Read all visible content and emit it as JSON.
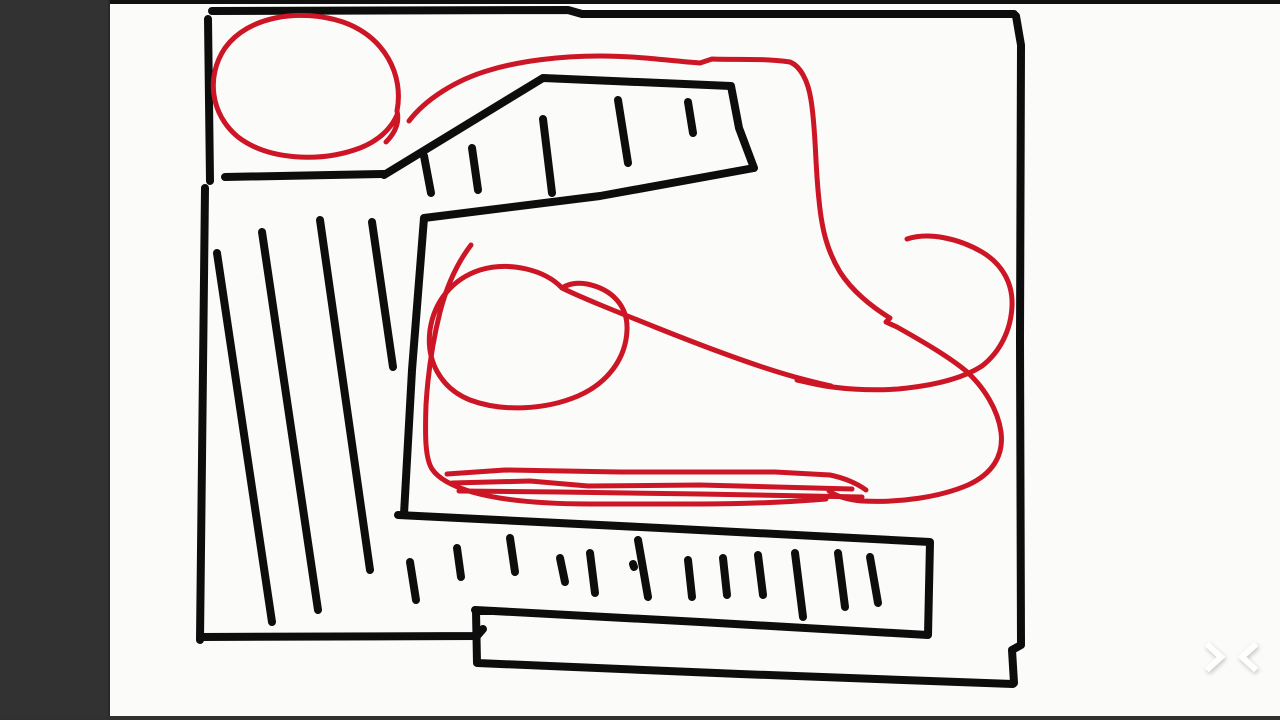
{
  "theme": {
    "frame_bg": "#141414",
    "top_strip": "#101010",
    "bottom_strip": "#303030",
    "sidebar": "#323232",
    "sidebar_edge": "#282828",
    "canvas": "#fbfbfa",
    "chevron": "#ffffff",
    "ink_black": "#0d0d0d",
    "ink_red": "#cc1626"
  },
  "nav": {
    "icons": [
      {
        "name": "chevron-right-icon",
        "shape": "right"
      },
      {
        "name": "chevron-left-icon",
        "shape": "left"
      }
    ]
  },
  "drawing": {
    "black_width": 8,
    "red_width": 5,
    "strokes": [
      {
        "id": "border-top",
        "color": "black",
        "path": "M 212 11 L 568 10 L 582 14 L 1014 14"
      },
      {
        "id": "border-right",
        "color": "black",
        "path": "M 1016 16 L 1021 45 L 1020 340 L 1021 645 L 1012 650 L 1014 683"
      },
      {
        "id": "border-left-upper",
        "color": "black",
        "path": "M 208 19 L 210 181"
      },
      {
        "id": "border-left-lower",
        "color": "black",
        "path": "M 205 188 L 200 640"
      },
      {
        "id": "border-bottom-left",
        "color": "black",
        "path": "M 201 637 L 477 636 L 483 629"
      },
      {
        "id": "shelf-line",
        "color": "black",
        "path": "M 225 177 L 384 174"
      },
      {
        "id": "ruler-top-outline",
        "color": "black",
        "path": "M 384 175 L 543 78 L 731 86 L 739 128 L 754 168 L 600 196 L 424 218 L 412 370 L 404 514"
      },
      {
        "id": "ruler-top-tick-1",
        "color": "black",
        "path": "M 424 156 L 431 193"
      },
      {
        "id": "ruler-top-tick-2",
        "color": "black",
        "path": "M 472 148 L 478 190"
      },
      {
        "id": "ruler-top-tick-3",
        "color": "black",
        "path": "M 543 119 L 552 193"
      },
      {
        "id": "ruler-top-tick-4",
        "color": "black",
        "path": "M 618 100 L 628 163"
      },
      {
        "id": "ruler-top-tick-5",
        "color": "black",
        "path": "M 688 102 L 693 133"
      },
      {
        "id": "hatch-line-1",
        "color": "black",
        "path": "M 217 253 L 272 622"
      },
      {
        "id": "hatch-line-2",
        "color": "black",
        "path": "M 262 232 L 318 610"
      },
      {
        "id": "hatch-line-3",
        "color": "black",
        "path": "M 320 220 L 370 570"
      },
      {
        "id": "hatch-line-4",
        "color": "black",
        "path": "M 372 222 L 393 367"
      },
      {
        "id": "ruler-bottom-outline",
        "color": "black",
        "path": "M 398 515 L 660 528 L 930 542 L 928 635 L 700 622 L 475 610"
      },
      {
        "id": "ruler-bottom-tick-1",
        "color": "black",
        "path": "M 410 562 L 416 600"
      },
      {
        "id": "ruler-bottom-tick-2",
        "color": "black",
        "path": "M 457 548 L 461 577"
      },
      {
        "id": "ruler-bottom-tick-3",
        "color": "black",
        "path": "M 510 538 L 515 572"
      },
      {
        "id": "ruler-bottom-tick-4",
        "color": "black",
        "path": "M 560 558 L 565 582"
      },
      {
        "id": "ruler-bottom-tick-5",
        "color": "black",
        "path": "M 590 553 L 595 593"
      },
      {
        "id": "ruler-bottom-tick-6",
        "color": "black",
        "path": "M 638 540 L 648 597"
      },
      {
        "id": "ruler-bottom-dot",
        "color": "black",
        "path": "M 633 564 L 634 567"
      },
      {
        "id": "ruler-bottom-tick-7",
        "color": "black",
        "path": "M 688 560 L 692 597"
      },
      {
        "id": "ruler-bottom-tick-8",
        "color": "black",
        "path": "M 723 558 L 727 595"
      },
      {
        "id": "ruler-bottom-tick-9",
        "color": "black",
        "path": "M 758 555 L 763 595"
      },
      {
        "id": "ruler-bottom-tick-10",
        "color": "black",
        "path": "M 795 553 L 803 617"
      },
      {
        "id": "ruler-bottom-tick-11",
        "color": "black",
        "path": "M 838 553 L 845 607"
      },
      {
        "id": "ruler-bottom-tick-12",
        "color": "black",
        "path": "M 870 557 L 878 603"
      },
      {
        "id": "bottom-bar",
        "color": "black",
        "path": "M 494 611 L 476 611 L 477 663 L 740 674 L 1013 684"
      },
      {
        "id": "red-circle-top-left",
        "color": "red",
        "path": "M 386 142 C 394 134 400 124 397 111 C 404 75 385 37 343 22 C 300 8 248 16 225 48 C 206 76 210 114 238 137 C 268 160 320 163 360 148 C 378 141 391 129 397 115"
      },
      {
        "id": "red-swoosh-descender",
        "color": "red",
        "path": "M 409 121 C 425 100 455 80 490 70 C 520 61 560 56 600 56 C 640 56 670 61 700 63 L 712 59 C 735 60 760 58 790 62 C 800 66 808 80 811 100 C 816 130 815 165 819 200 C 822 232 828 252 840 272 C 852 291 872 307 890 318 L 886 322 L 897 327 C 920 340 948 356 966 371 C 984 387 998 410 1001 432 C 1004 456 992 474 968 485 C 940 497 900 503 862 501 C 848 500 836 496 829 491"
      },
      {
        "id": "red-right-hook",
        "color": "red",
        "path": "M 907 239 C 928 232 958 238 982 252 C 1002 264 1013 283 1012 306 C 1011 330 1000 352 982 366 C 962 379 930 386 898 389 C 870 391 838 389 815 384 L 797 380"
      },
      {
        "id": "red-oval-and-tail",
        "color": "red",
        "path": "M 562 288 C 545 270 510 261 480 270 C 452 279 434 302 430 330 C 426 360 440 388 470 400 C 502 412 545 410 578 396 C 608 383 626 358 627 330 C 628 306 612 289 587 284 C 577 282 568 284 562 288 C 580 297 615 311 655 327 C 700 345 755 366 795 377 C 810 381 822 384 831 386"
      },
      {
        "id": "red-heel-and-sole-outline",
        "color": "red",
        "path": "M 471 245 C 458 262 447 285 440 312 C 433 340 428 372 426 405 C 425 435 425 458 432 469 C 438 478 452 486 472 492 C 500 500 540 504 590 504 L 700 504 C 745 504 790 502 826 499"
      },
      {
        "id": "red-sole-line-1",
        "color": "red",
        "path": "M 447 474 L 505 470 L 620 472 L 775 472 L 830 475 C 845 478 858 484 866 490"
      },
      {
        "id": "red-sole-line-2",
        "color": "red",
        "path": "M 452 483 L 530 481 L 588 486 L 700 485 L 852 489"
      },
      {
        "id": "red-sole-line-3",
        "color": "red",
        "path": "M 459 491 L 560 492 L 700 494 L 862 497"
      }
    ]
  }
}
